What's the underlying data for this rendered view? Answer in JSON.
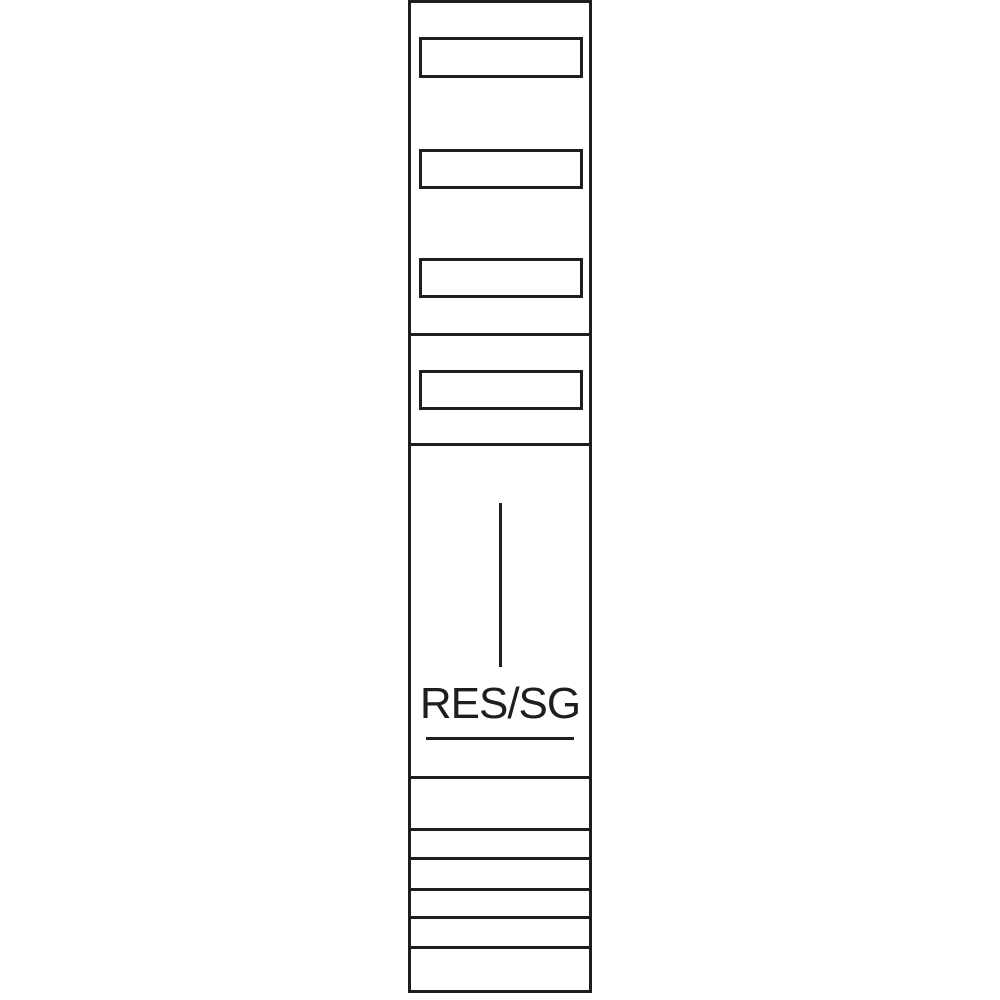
{
  "image": {
    "kind": "technical line drawing of a vertical meter-panel field",
    "background_color": "#ffffff",
    "line_color": "#1e1e1e"
  },
  "panel": {
    "label": "RES/SG",
    "label_underlined": true,
    "label_window_count": 4,
    "section_divider_count": 8,
    "bottom_rail_count": 5,
    "has_vertical_marker_line": true
  }
}
